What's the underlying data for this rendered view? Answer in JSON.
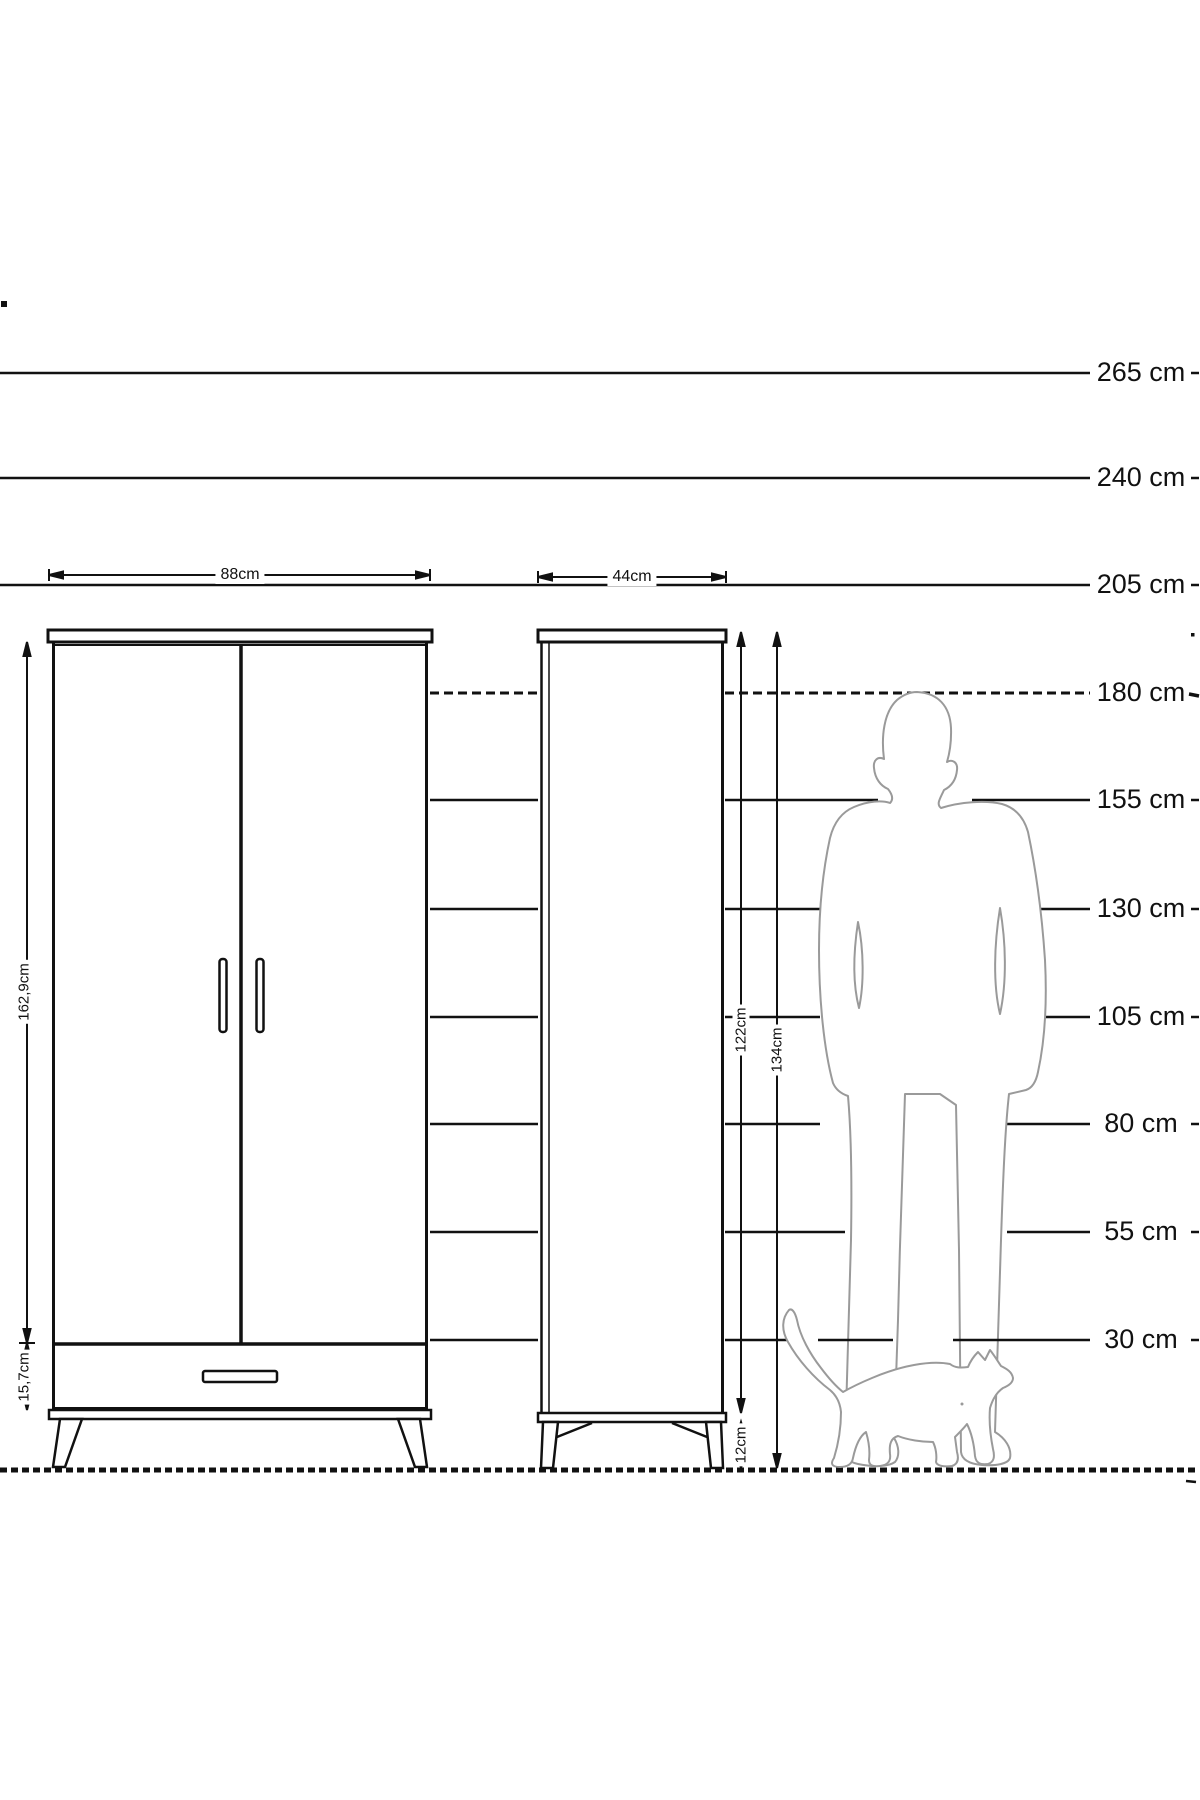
{
  "scale": {
    "unit": "cm",
    "labels": [
      "265 cm",
      "240 cm",
      "205 cm",
      "180 cm",
      "155 cm",
      "130 cm",
      "105 cm",
      "80 cm",
      "55 cm",
      "30 cm"
    ],
    "values": [
      265,
      240,
      205,
      180,
      155,
      130,
      105,
      80,
      55,
      30
    ]
  },
  "wardrobe": {
    "name": "two-door wardrobe with drawer",
    "width_label": "88cm",
    "body_height_label": "162,9cm",
    "drawer_height_label": "15,7cm"
  },
  "cabinet": {
    "name": "tall single-door cabinet",
    "width_label": "44cm",
    "body_height_label": "122cm",
    "total_height_label": "134cm",
    "leg_height_label": "12cm"
  },
  "figures": {
    "man": "standing-man-silhouette",
    "cat": "walking-cat-silhouette"
  },
  "colors": {
    "ink": "#111111",
    "silhouette": "#9a9a9a",
    "background": "#ffffff"
  },
  "measurements": {
    "scale_lines_cm": [
      265,
      240,
      205,
      180,
      155,
      130,
      105,
      80,
      55,
      30
    ],
    "wardrobe": {
      "width_cm": 88,
      "body_height_cm": 162.9,
      "drawer_height_cm": 15.7
    },
    "cabinet": {
      "width_cm": 44,
      "body_height_cm": 122,
      "total_height_cm": 134,
      "leg_height_cm": 12
    }
  }
}
